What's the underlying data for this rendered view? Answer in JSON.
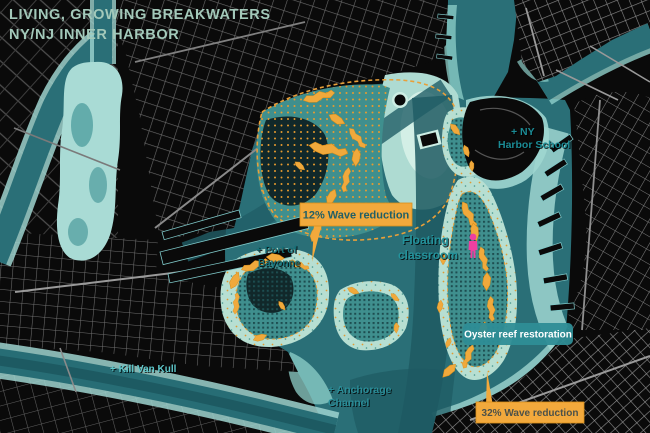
{
  "title": {
    "line1": "LIVING, GROWING BREAKWATERS",
    "line2": "NY/NJ INNER HARBOR"
  },
  "callouts": {
    "wave12": "12% Wave reduction",
    "wave32": "32% Wave reduction",
    "oyster_reef": "Oyster reef restoration"
  },
  "map_labels": {
    "port_of_bayonne_1": "+ Port of",
    "port_of_bayonne_2": "Bayonne",
    "floating_classroom_1": "Floating",
    "floating_classroom_2": "classroom",
    "ny_harbor_school_1": "+ NY",
    "ny_harbor_school_2": "Harbor School",
    "kill_van_kull": "+ Kill Van Kull",
    "anchorage_channel_1": "+ Anchorage",
    "anchorage_channel_2": "Channel"
  },
  "icons": {
    "floating_classroom_marker": "person-icon"
  },
  "colors": {
    "land": "#0a0a0a",
    "streets": "#6f6f6f",
    "water": "#2a6f77",
    "water_deep": "#1e5a62",
    "water_light": "#8fd0ca",
    "flats": "#aedbd2",
    "flats_bright": "#d3efe6",
    "reef_base": "#3f8f8e",
    "reef_grid_dark": "#1d4d50",
    "speckle_bg": "#b7dfd2",
    "breakwater_orange": "#f0a93c",
    "callout_orange": "#f2a93c",
    "callout_text": "#215f66",
    "box_teal": "#2e8d96",
    "label_teal": "#1b8b95",
    "label_teal_bright": "#5ec7ca",
    "marker_pink": "#ee3fa0",
    "title_text": "#a3c9ba"
  }
}
